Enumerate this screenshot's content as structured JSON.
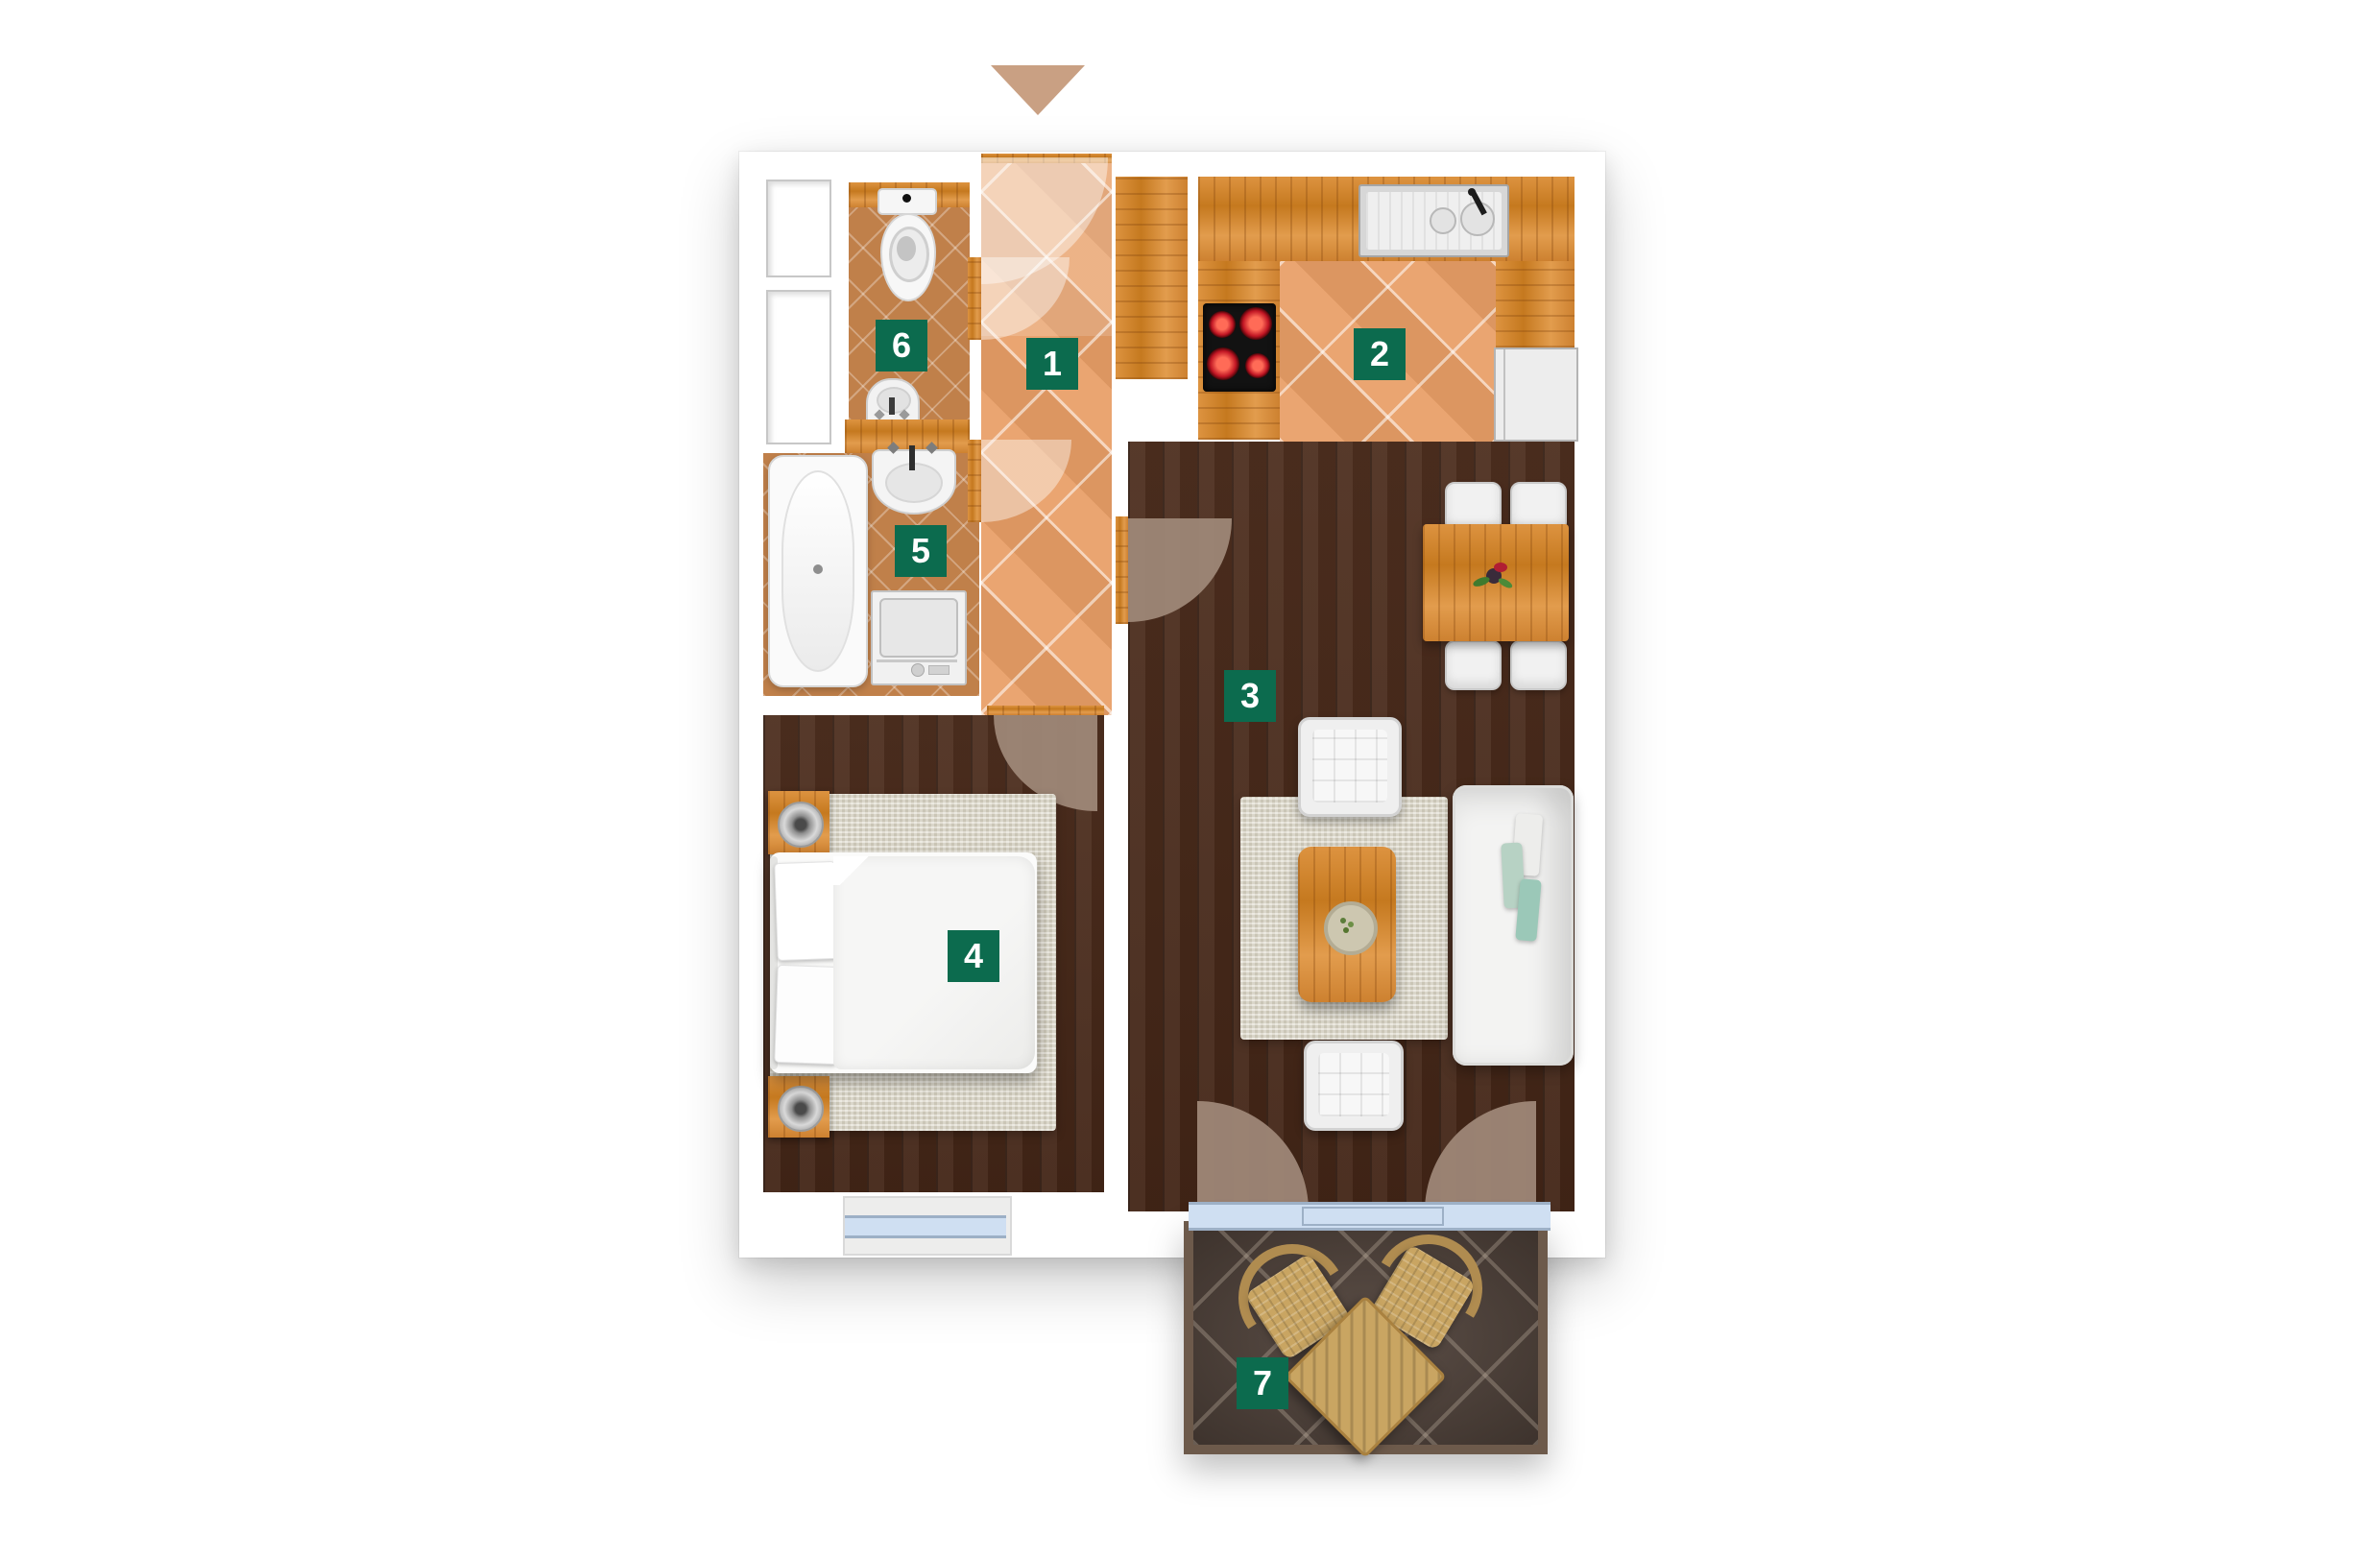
{
  "title": "apartment-floor-plan",
  "entrance": {
    "marker_icon": "triangle-down-icon",
    "direction": "down"
  },
  "rooms": [
    {
      "key": "hallway",
      "label": "1"
    },
    {
      "key": "kitchen",
      "label": "2"
    },
    {
      "key": "living-room",
      "label": "3"
    },
    {
      "key": "bedroom",
      "label": "4"
    },
    {
      "key": "bathroom",
      "label": "5"
    },
    {
      "key": "wc",
      "label": "6"
    },
    {
      "key": "balcony",
      "label": "7"
    }
  ],
  "fixtures": [
    "toilet",
    "wc-sink",
    "bathtub",
    "bathroom-sink",
    "washing-machine",
    "kitchen-sink",
    "cooktop",
    "fridge-cabinet",
    "dining-table",
    "dining-chairs",
    "sofa",
    "armchairs",
    "coffee-table",
    "double-bed",
    "nightstands",
    "wicker-chairs",
    "wicker-table"
  ],
  "colors": {
    "label-bg": "#0c6b4e",
    "label-text": "#ffffff",
    "tile-orange": "#e89e66",
    "tile-small": "#c0804a",
    "wood": "#d2892f",
    "floor-dark": "#482818",
    "balcony-tile": "#52443c",
    "glazing": "#cfdff2",
    "arrow": "#c9a083"
  }
}
